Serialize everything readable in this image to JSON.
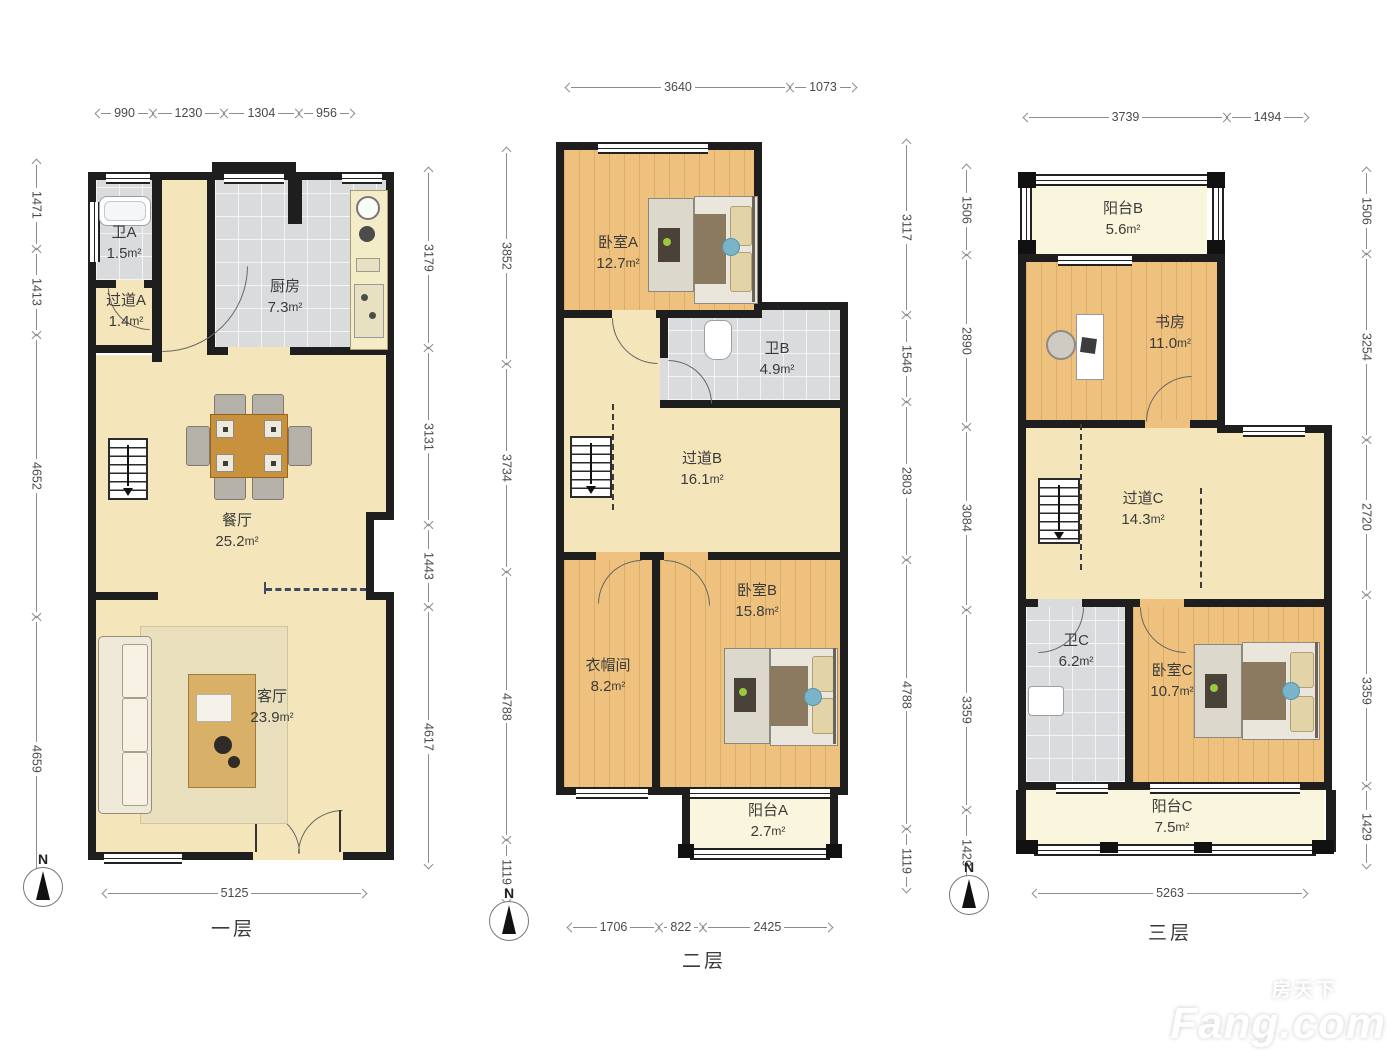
{
  "meta": {
    "compass": "N",
    "area_unit": "m²"
  },
  "watermark": {
    "cn": "房天下",
    "en": "Fang.com"
  },
  "floors": {
    "f1": {
      "label": "一层",
      "dims": {
        "top": [
          "990",
          "1230",
          "1304",
          "956"
        ],
        "left": [
          "1471",
          "1413",
          "4652",
          "4659"
        ],
        "right": [
          "3179",
          "3131",
          "1443",
          "4617"
        ],
        "bottom": [
          "5125"
        ]
      },
      "rooms": {
        "wei_a": {
          "name": "卫A",
          "area": "1.5"
        },
        "guodao_a": {
          "name": "过道A",
          "area": "1.4"
        },
        "chufang": {
          "name": "厨房",
          "area": "7.3"
        },
        "canting": {
          "name": "餐厅",
          "area": "25.2"
        },
        "keting": {
          "name": "客厅",
          "area": "23.9"
        }
      }
    },
    "f2": {
      "label": "二层",
      "dims": {
        "top": [
          "3640",
          "1073"
        ],
        "left": [
          "3852",
          "3734",
          "4788",
          "1119"
        ],
        "right": [
          "3117",
          "1546",
          "2803",
          "4788",
          "1119"
        ],
        "bottom": [
          "1706",
          "822",
          "2425"
        ]
      },
      "rooms": {
        "woshi_a": {
          "name": "卧室A",
          "area": "12.7"
        },
        "wei_b": {
          "name": "卫B",
          "area": "4.9"
        },
        "guodao_b": {
          "name": "过道B",
          "area": "16.1"
        },
        "yimaojian": {
          "name": "衣帽间",
          "area": "8.2"
        },
        "woshi_b": {
          "name": "卧室B",
          "area": "15.8"
        },
        "yangtai_a": {
          "name": "阳台A",
          "area": "2.7"
        }
      }
    },
    "f3": {
      "label": "三层",
      "dims": {
        "top": [
          "3739",
          "1494"
        ],
        "left": [
          "1506",
          "2890",
          "3084",
          "3359",
          "1429"
        ],
        "right": [
          "1506",
          "3254",
          "2720",
          "3359",
          "1429"
        ],
        "bottom": [
          "5263"
        ]
      },
      "rooms": {
        "yangtai_b": {
          "name": "阳台B",
          "area": "5.6"
        },
        "shufang": {
          "name": "书房",
          "area": "11.0"
        },
        "guodao_c": {
          "name": "过道C",
          "area": "14.3"
        },
        "wei_c": {
          "name": "卫C",
          "area": "6.2"
        },
        "woshi_c": {
          "name": "卧室C",
          "area": "10.7"
        },
        "yangtai_c": {
          "name": "阳台C",
          "area": "7.5"
        }
      }
    }
  }
}
